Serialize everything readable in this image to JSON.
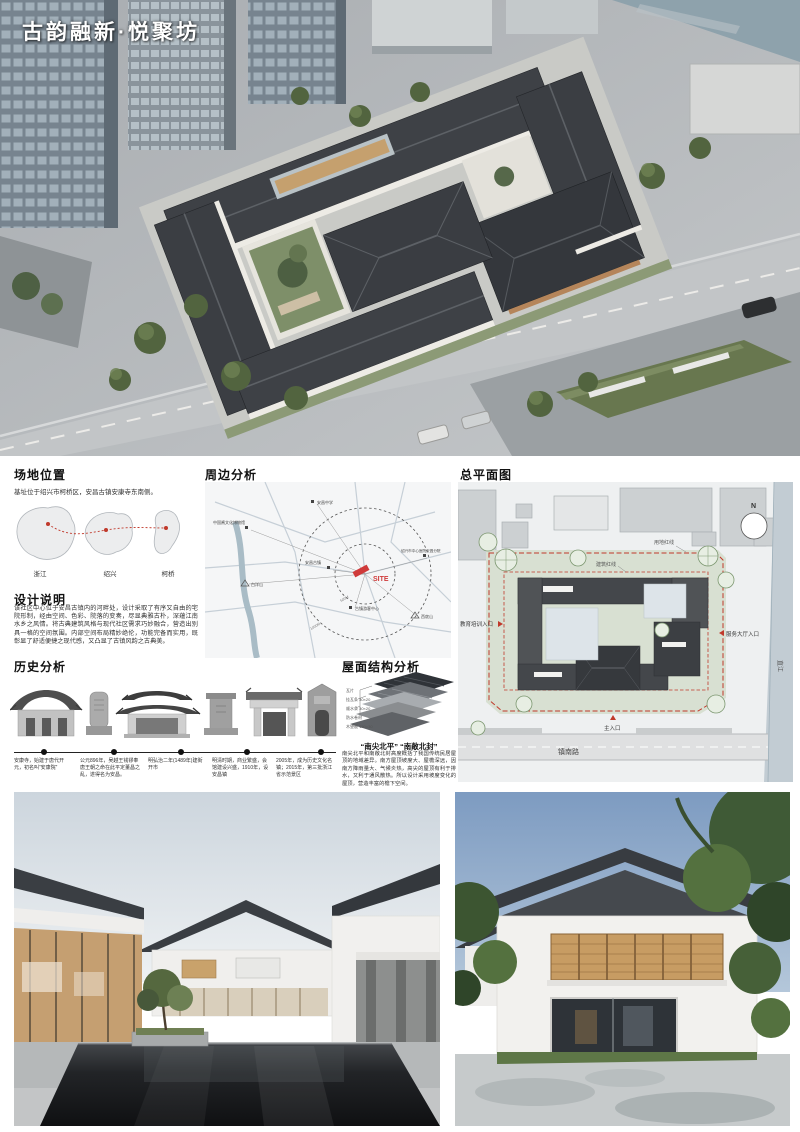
{
  "title": "古韵融新·悦聚坊",
  "site_location": {
    "heading": "场地位置",
    "caption": "基址位于绍兴市柯桥区，安昌古镇安康寺东南侧。",
    "map_labels": [
      "浙江",
      "绍兴",
      "柯桥"
    ]
  },
  "design_notes": {
    "heading": "设计说明",
    "body": "该社区中心位于安昌古镇内的河畔处，设计采取了有序又自由的宅院形制，经由空间、色彩、院落的变奏，尽显典雅古朴，深蕴江南水乡之风情。将古典建筑风格与现代社区需求巧妙融合，营造出别具一格的空间氛围。内部空间布局精妙绝伦，功能完备而实用，既彰显了舒适便捷之现代感，又凸显了古镇风韵之古典美。"
  },
  "surrounding": {
    "heading": "周边分析",
    "site_label": "SITE",
    "poi": [
      "安昌中学",
      "中国酱文化博物馆",
      "绍兴市中心医院安昌分院",
      "安昌古镇",
      "古镇游客中心",
      "白洋山",
      "西扆山"
    ],
    "rings": [
      "500M",
      "1000M"
    ]
  },
  "master_plan": {
    "heading": "总平面图",
    "labels": {
      "site_redline": "用地红线",
      "building_redline": "建筑红线",
      "north": "N",
      "entrance_edu": "教育培训入口",
      "entrance_service": "服务大厅入口",
      "entrance_main": "主入口",
      "road": "镇南路",
      "river": "直江"
    }
  },
  "history": {
    "heading": "历史分析",
    "timeline": [
      {
        "text": "安康寺，始建于唐代开元，初名叫“安康院”"
      },
      {
        "text": "公元896年，吴越王钱镠奉唐王朝之命在此平定董昌之乱，遂得名为安昌。"
      },
      {
        "text": "明弘治二年(1489年)建街开市"
      },
      {
        "text": "明清时期，商业繁盛，会馆建设兴盛，1910年，设安昌镇"
      },
      {
        "text": "2005年，成为历史文化名镇；2015年，第三批浙江省示范景区"
      }
    ]
  },
  "roof": {
    "heading": "屋面结构分析",
    "subtitle": "“南尖北平” “南敞北封”",
    "body": "南尖北平和南敞北封高度概括了我国传统民居屋顶的地域差异。南方屋顶坡度大、屋檐深远，因南方降雨量大、气候炎热，高尖的屋顶有利于排水，又利于通风散热。所以设计采用坡度变化的屋顶，营造丰富的檐下空间。",
    "layers": [
      "瓦片",
      "挂瓦条 30×20",
      "顺水条 30×20",
      "防水卷材",
      "木望板 150×30"
    ]
  },
  "colors": {
    "accent_red": "#c0392b",
    "roof_dark": "#3a3d42",
    "site_green": "#d8e0d2"
  }
}
